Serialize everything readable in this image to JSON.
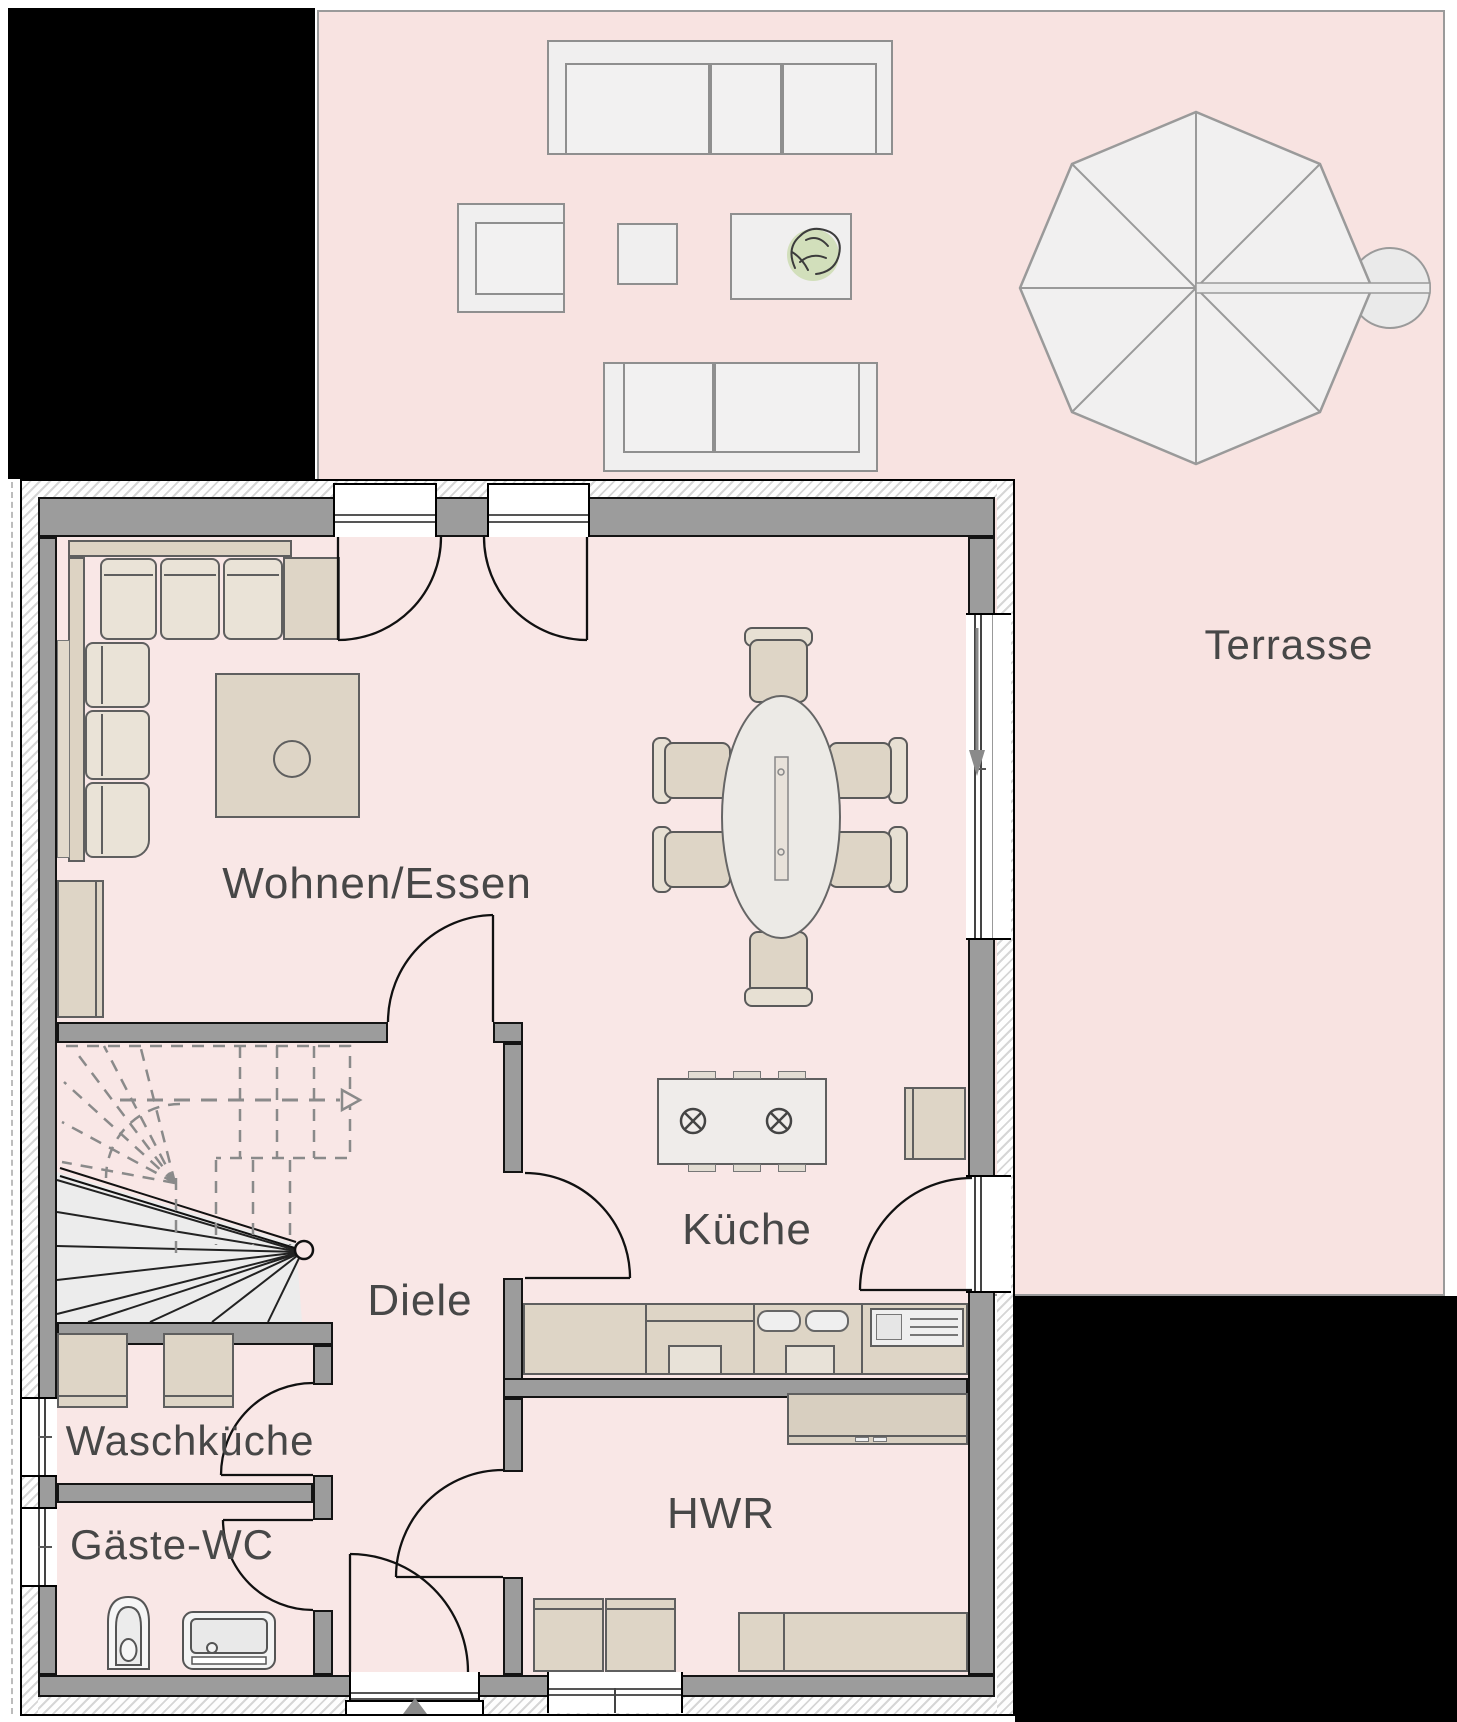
{
  "title": "Erdgeschoss Grundriss",
  "rooms": {
    "terrasse": {
      "label": "Terrasse"
    },
    "wohnen_essen": {
      "label": "Wohnen/Essen"
    },
    "kueche": {
      "label": "Küche"
    },
    "diele": {
      "label": "Diele"
    },
    "waschkueche": {
      "label": "Waschküche"
    },
    "gaeste_wc": {
      "label": "Gäste-WC"
    },
    "hwr": {
      "label": "HWR"
    }
  },
  "icons": {
    "entrance_arrow": "up-triangle",
    "slide_direction_arrow": "down-arrow",
    "stair_walkline_arrow": "right-triangle",
    "hob_burner": "circled-cross",
    "parasol": "octagon-umbrella"
  },
  "colors": {
    "floor": "#f9e7e6",
    "terrace": "#f8e3e1",
    "wall": "#9c9c9c",
    "outline": "#141414",
    "furn": "#ded5c6",
    "furn_light": "#eae3d7",
    "furn_outline": "#5f5f5f",
    "terrace_furn": "#f0efef",
    "terrace_outline": "#8f8f8f",
    "label": "#474747",
    "mask": "#000000",
    "stair": "#8a8a8a",
    "plant": "#ccdcb2"
  }
}
